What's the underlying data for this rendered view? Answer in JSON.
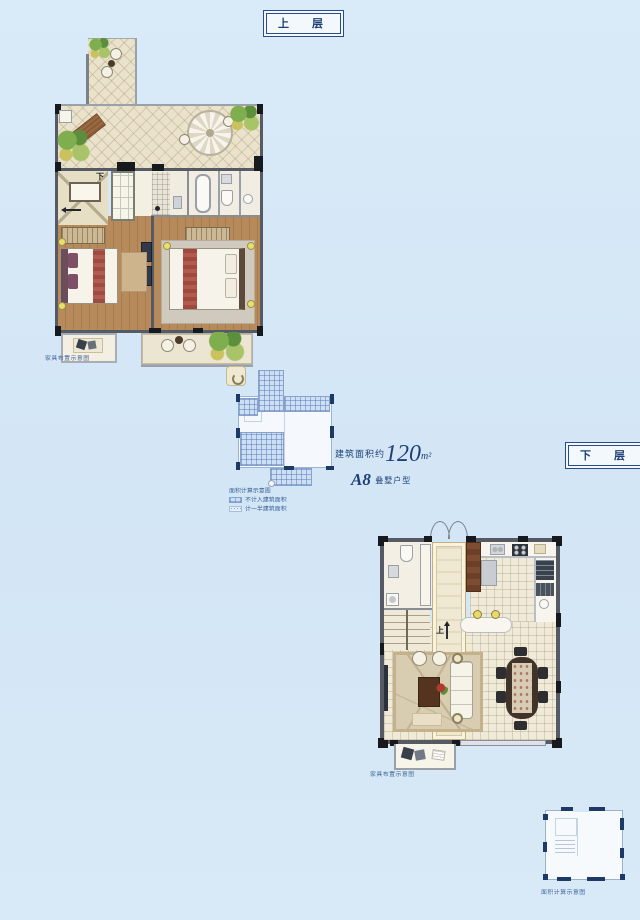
{
  "page": {
    "background": "#d6e8f6"
  },
  "floors": {
    "upper": {
      "label": "上 层",
      "stair_note": "下"
    },
    "lower": {
      "label": "下 层",
      "stair_note": "上"
    }
  },
  "summary": {
    "area_prefix": "建筑面积约",
    "area_value": "120",
    "area_unit": "m²",
    "model_code": "A8",
    "model_suffix": "叠墅户型"
  },
  "legend": {
    "title": "面积计算示意图",
    "items": [
      {
        "swatch": "grid-hatch",
        "label": "不计入建筑面积"
      },
      {
        "swatch": "dot-hatch",
        "label": "计一半建筑面积"
      }
    ]
  },
  "captions": {
    "upper_plan": "家具布置示意图",
    "lower_plan": "家具布置示意图",
    "lower_schematic": "面积计算示意图"
  },
  "colors": {
    "accent_navy": "#1e4076",
    "wall": "#565b63",
    "terrace_tile": "#eae2ca",
    "wood_floor": "#b78a5c",
    "hatch_blue": "#87a3cc"
  }
}
